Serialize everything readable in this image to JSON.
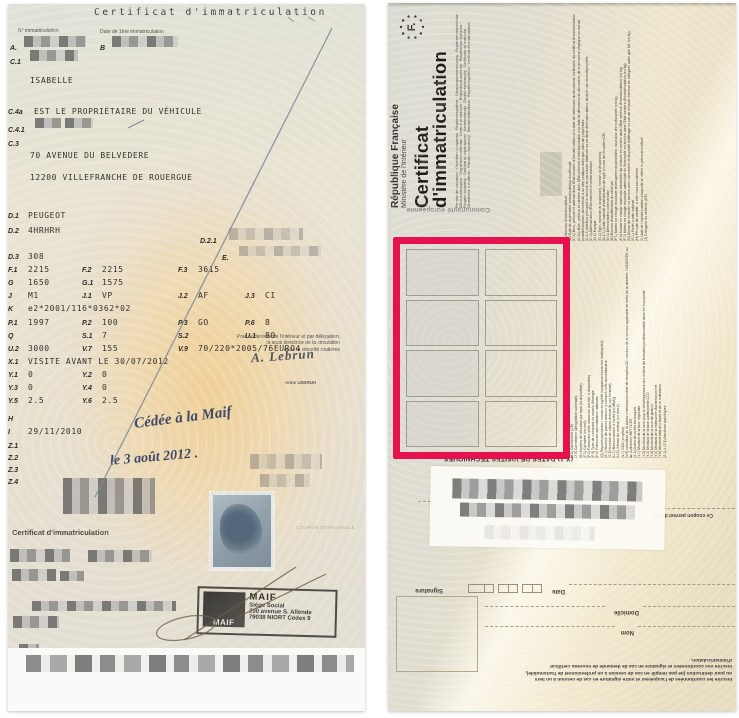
{
  "front": {
    "title": "Certificat d'immatriculation",
    "labels": {
      "immat_no": "N° immatriculation",
      "first_date": "Date de 1ère immatriculation"
    },
    "fields": [
      {
        "c": "A.",
        "v": ""
      },
      {
        "c": "B",
        "v": ""
      },
      {
        "c": "C.1",
        "v": ""
      },
      {
        "c": "",
        "v": "ISABELLE"
      },
      {
        "c": "C.4a",
        "v": "EST LE PROPRIÉTAIRE DU VÉHICULE"
      },
      {
        "c": "C.4.1",
        "v": ""
      },
      {
        "c": "C.3",
        "v": ""
      },
      {
        "c": "",
        "v": "70 AVENUE DU BELVEDERE"
      },
      {
        "c": "",
        "v": "12200 VILLEFRANCHE DE ROUERGUE"
      },
      {
        "c": "D.1",
        "v": "PEUGEOT"
      },
      {
        "c": "D.2",
        "v": "4HRHRH"
      },
      {
        "c": "D.2.1",
        "v": ""
      },
      {
        "c": "D.3",
        "v": "308"
      },
      {
        "c": "E.",
        "v": ""
      },
      {
        "c": "F.1",
        "v": "2215"
      },
      {
        "c": "F.2",
        "v": "2215"
      },
      {
        "c": "F.3",
        "v": "3615"
      },
      {
        "c": "G",
        "v": "1650"
      },
      {
        "c": "G.1",
        "v": "1575"
      },
      {
        "c": "J",
        "v": "M1"
      },
      {
        "c": "J.1",
        "v": "VP"
      },
      {
        "c": "J.2",
        "v": "AF"
      },
      {
        "c": "J.3",
        "v": "CI"
      },
      {
        "c": "K",
        "v": "e2*2001/116*0362*02"
      },
      {
        "c": "P.1",
        "v": "1997"
      },
      {
        "c": "P.2",
        "v": "100"
      },
      {
        "c": "P.3",
        "v": "GO"
      },
      {
        "c": "P.6",
        "v": "8"
      },
      {
        "c": "Q",
        "v": ""
      },
      {
        "c": "S.1",
        "v": "7"
      },
      {
        "c": "S.2",
        "v": ""
      },
      {
        "c": "U.1",
        "v": "80"
      },
      {
        "c": "U.2",
        "v": "3000"
      },
      {
        "c": "V.7",
        "v": "155"
      },
      {
        "c": "V.9",
        "v": "70/220*2005/76EURO4"
      },
      {
        "c": "X.1",
        "v": "VISITE AVANT LE 30/07/2012"
      },
      {
        "c": "Y.1",
        "v": "0"
      },
      {
        "c": "Y.2",
        "v": "0"
      },
      {
        "c": "Y.3",
        "v": "0"
      },
      {
        "c": "Y.4",
        "v": "0"
      },
      {
        "c": "Y.5",
        "v": "2.5"
      },
      {
        "c": "Y.6",
        "v": "2.5"
      },
      {
        "c": "H",
        "v": ""
      },
      {
        "c": "I",
        "v": "29/11/2010"
      },
      {
        "c": "Z.1",
        "v": ""
      },
      {
        "c": "Z.2",
        "v": ""
      },
      {
        "c": "Z.3",
        "v": ""
      },
      {
        "c": "Z.4",
        "v": ""
      }
    ],
    "ministry_note": [
      "Pour le ministre de l'intérieur et par délégation,",
      "la sous directrice de la circulation",
      "et de la sécurité routières"
    ],
    "signature_name": "A. Lebrun",
    "signatory": "Anne LEBRUN",
    "handwriting_line1": "Cédée à la Maif",
    "handwriting_line2": "le 3 août 2012 .",
    "coupon_label": "Certificat d'immatriculation",
    "coupon_detachable": "COUPON DÉTACHABLE",
    "maif_stamp": {
      "logo": "MAIF",
      "name": "MAIF",
      "lines": [
        "Siège Social",
        "200 avenue S. Allende",
        "79038 NIORT Cedex 9"
      ]
    }
  },
  "back": {
    "country_letter": "F.",
    "republic": "République Française",
    "ministry": "Ministère de l'Intérieur",
    "title1": "Certificat",
    "title2": "d'immatriculation",
    "translations": "Permiso de circulación · Osvědčení o registraci · Registreringsattest · Zulassungsbescheinigung · Registreerimistunnistus · Άδεια κυκλοφορίας · Registration certificate · Carta di circolazione · Reģistrācijas apliecība · Registracijos liudijimas · Forgalmi engedély · Ċertifikat ta' reġistrazzjoni · Kentekenbewijs · Dowód rejestracyjny · Certificado de matrícula · Osvedčenie o evidencii · Potrdilo o registraciji · Rekisteröintitodistus · Registreringsbevis · Certificat d'immatriculation",
    "community": "Communauté européenne",
    "x1_header": "(X.1) DATES DE VISITES TECHNIQUES",
    "code_route_fragment": "du code de la route",
    "coupon_note": "Ce coupon permet de circuler",
    "highlight_color": "#e81150",
    "legend_top": [
      "(A) Numéro d'immatriculation",
      "(B) Date de la première immatriculation du véhicule",
      "(C.1) Nom, prénom et adresse dans l'État membre d'immatriculation à la date de délivrance du document, du titulaire du certificat d'immatriculation",
      "(C.4a) Nom, prénom et adresse dans l'État membre d'immatriculation à la date de délivrance du document, de la personne physique ou morale pouvant disposer du véhicule à un titre juridique autre que celui de propriétaire",
      "(C.4.1) Mention précisant le nombre de personnes titulaires du certificat d'immatriculation, dans le cas de multipropriété",
      "(C.3) Adresse dans l'État membre d'immatriculation",
      "(D.1) Marque",
      "(D.2) Type, variante (si disponible), version (si disponible)",
      "(D.2.1) Code national d'identification du type (en cas de réception CE)",
      "(D.3) Dénomination commerciale",
      "(E) Numéro d'identification du véhicule",
      "(F.1) Masse en charge maximale techniquement admissible, sauf pour les motocycles (en kg)",
      "(F.2) Masse en charge maximale admissible du véhicule en service dans l'État membre d'immatriculation (en kg)",
      "(F.3) Masse en charge maximale admissible de l'ensemble en service dans l'État membre d'immatriculation (en kg)",
      "(G) Masse du véhicule en service avec carrosserie et dispositif d'attelage en cas de véhicule tracteur de catégorie autre que M1 (en kg)",
      "(G.1) Poids à vide national",
      "(H) Période de validité, si elle n'est pas illimitée",
      "(I) Date de l'immatriculation à laquelle se réfère le présent certificat",
      "(J) Catégorie du véhicule (CE)"
    ],
    "legend_bottom": [
      "(J.1) Genre national",
      "(J.2) Carrosserie (CE)",
      "(J.3) Carrosserie (désignation nationale)",
      "(K) Numéro de réception par type (si disponible)",
      "(P.1) Cylindrée (en cm3)",
      "(P.2) Puissance nette maximale (en kW, si disponible)",
      "(P.3) Type de carburant ou source d'énergie",
      "(P.6) Puissance administrative nationale",
      "(Q) Rapport puissance / masse en kg/kW (uniquement pour les motocycles)",
      "(S.1) Nombre de places assises, y compris celle du conducteur",
      "(S.2) Nombre de places debout (le cas échéant)",
      "(U.1) Niveau sonore à l'arrêt [en dB(A)]",
      "(U.2) Vitesse du moteur (en min-1)",
      "(V.7) CO2 (en g/km)",
      "(V.9) Indication de la classe environnementale de réception CE, mention de la version applicable en vertu de la directive 70/220/CEE ou de la directive 88/77/CEE",
      "(X.1) Dates de visites techniques",
      "(Y.1) Montant de la taxe régionale",
      "(Y.2) Montant de la taxe pour le développement des actions de formation professionnelle dans les transports",
      "(Y.3) Montant de la taxe additionnelle CO2",
      "(Y.4) Montant de la taxe de gestion",
      "(Y.5) Montant de la redevance d'acheminement",
      "(Y.6) Montant total des taxes et de la redevance",
      "(Z.1) à (Z.4) Mentions spécifiques"
    ],
    "coupon": {
      "date_label": "Date",
      "signature_label": "Signature",
      "domicile_label": "Domicile",
      "nom_label": "Nom",
      "instructions": [
        "Inscrire les coordonnées de l'acquéreur et votre signature en cas de cession à un tiers",
        "ou pour destruction (ne pas remplir en cas de cession à un professionnel de l'automobile),",
        "inscrire vos coordonnées et signature en cas de demande de nouveau certificat",
        "d'immatriculation."
      ]
    }
  }
}
